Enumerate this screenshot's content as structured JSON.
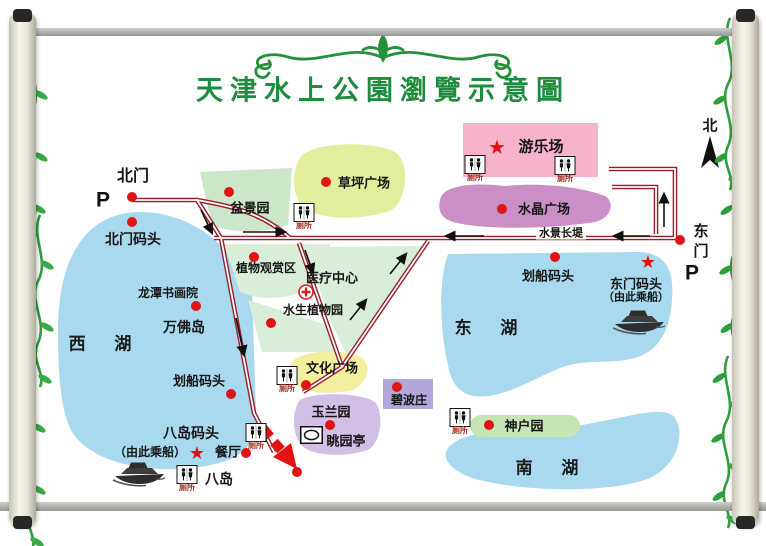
{
  "title": "天津水上公園瀏覽示意圖",
  "compass": {
    "north": "北"
  },
  "labels": {
    "north_gate": "北门",
    "north_dock": "北门码头",
    "parking": "P",
    "bonsai_garden": "盆景园",
    "lawn_plaza": "草坪广场",
    "amusement_park": "游乐场",
    "crystal_plaza": "水晶广场",
    "waterscape_causeway": "水景长堤",
    "east_gate": "东门",
    "plant_viewing_area": "植物观赏区",
    "medical_center": "医疗中心",
    "aquatic_plant_garden": "水生植物园",
    "longtan_academy": "龙潭书画院",
    "wanfo_island": "万佛岛",
    "west_lake": "西  湖",
    "east_lake": "东  湖",
    "south_lake": "南  湖",
    "boat_dock": "划船码头",
    "east_gate_dock": "东门码头",
    "board_here": "（由此乘船）",
    "culture_plaza": "文化广场",
    "magnolia_garden": "玉兰园",
    "tiaoyuan_pavilion": "眺园亭",
    "bibo_villa": "碧波庄",
    "kobe_garden": "神户园",
    "eight_island_dock": "八岛码头",
    "restaurant": "餐厅",
    "eight_island": "八岛",
    "toilet": "厕所"
  },
  "colors": {
    "title_green": "#1e8c3e",
    "vine_green": "#2f9e3c",
    "lake_blue": "#a9d9ee",
    "road_red": "#96202e",
    "marker_red": "#df1515",
    "amusement_pink": "#f6b3cb",
    "crystal_purple": "#c98fc6",
    "lawn_yellowgreen": "#e3ed9e",
    "bonsai_green": "#cbe6c8",
    "pale_green": "#d8eed8",
    "culture_yellow": "#f2efa0",
    "magnolia_purple": "#d2bfe6",
    "bibo_lavender": "#b3a6d9",
    "kobe_green": "#c5e5b5"
  }
}
